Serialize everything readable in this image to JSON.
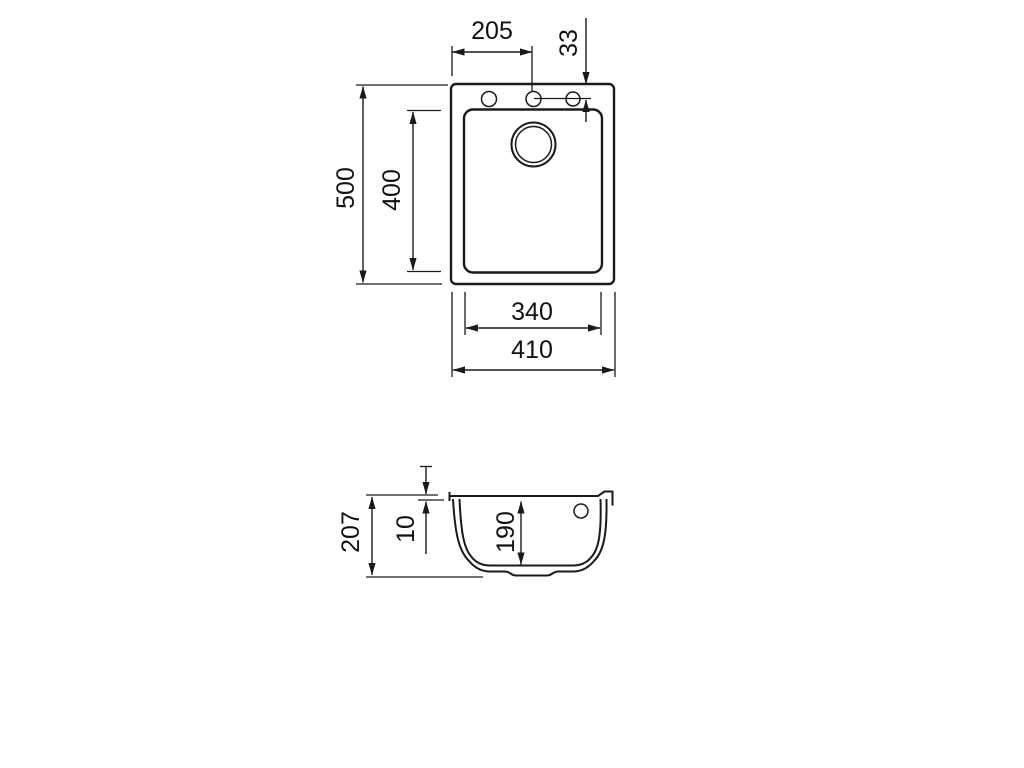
{
  "drawing": {
    "top_view": {
      "faucet_hole_offset_x": "205",
      "faucet_hole_offset_y": "33",
      "outer_depth": "500",
      "bowl_depth": "400",
      "bowl_width": "340",
      "outer_width": "410"
    },
    "section_view": {
      "overall_height": "207",
      "rim_thickness": "10",
      "bowl_inner_depth": "190"
    },
    "colors": {
      "line": "#1a1a1a",
      "background": "#ffffff"
    }
  }
}
